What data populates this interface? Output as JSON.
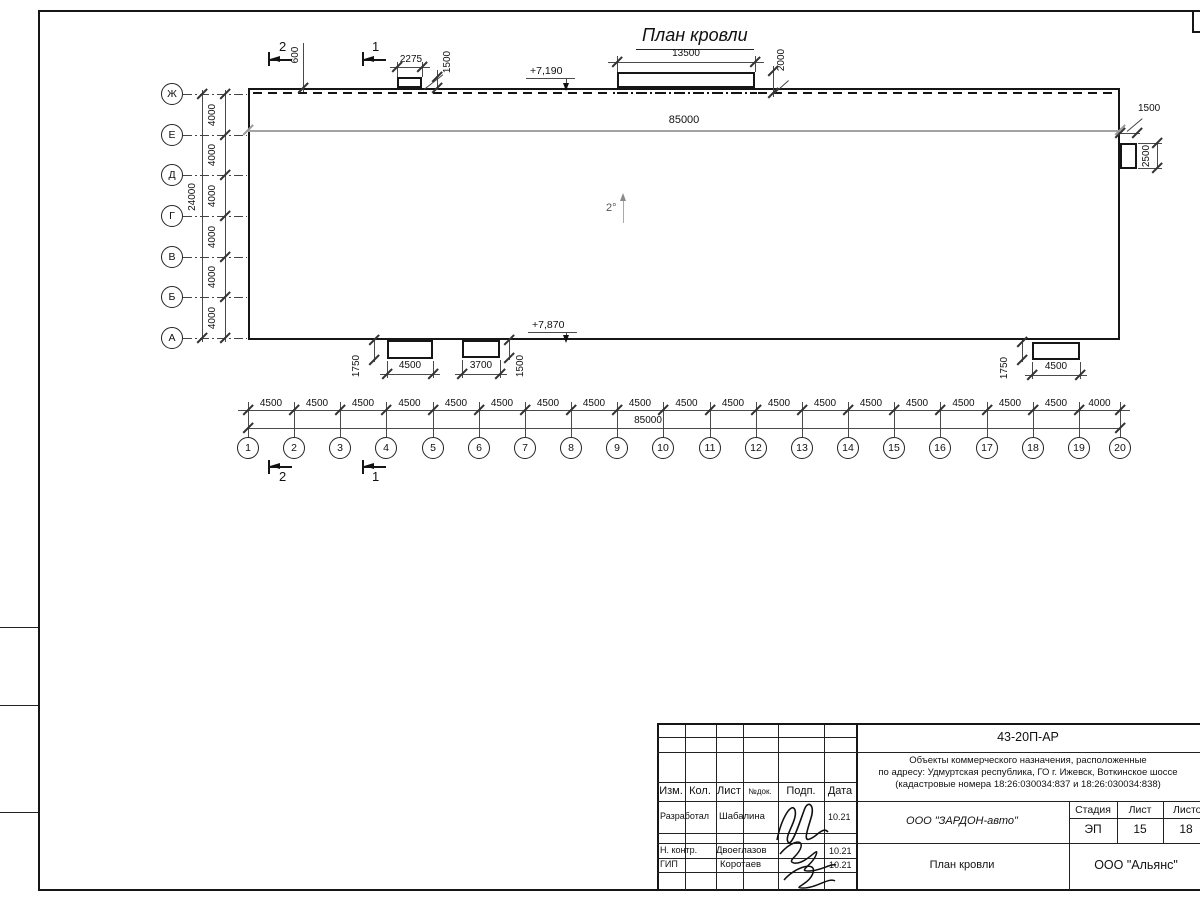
{
  "drawing": {
    "title": "План кровли",
    "slope_label": "2°",
    "elevation_top": "+7,190",
    "elevation_bottom": "+7,870",
    "total_width_top": "85000",
    "total_width_bottom": "85000"
  },
  "sections": {
    "s1": "1",
    "s2": "2"
  },
  "dims": {
    "top_parapet_offset": "600",
    "canopy_small_width": "2275",
    "canopy_small_depth": "1500",
    "canopy_big_width": "13500",
    "canopy_big_depth": "2000",
    "right_box_width": "1500",
    "right_box_depth": "2500",
    "bottom_a_width": "4500",
    "bottom_a_offset": "1750",
    "bottom_b_width": "3700",
    "bottom_b_offset": "1500",
    "bottom_c_width": "4500",
    "bottom_c_offset": "1750"
  },
  "grid": {
    "columns": [
      "1",
      "2",
      "3",
      "4",
      "5",
      "6",
      "7",
      "8",
      "9",
      "10",
      "11",
      "12",
      "13",
      "14",
      "15",
      "16",
      "17",
      "18",
      "19",
      "20"
    ],
    "column_bays": [
      "4500",
      "4500",
      "4500",
      "4500",
      "4500",
      "4500",
      "4500",
      "4500",
      "4500",
      "4500",
      "4500",
      "4500",
      "4500",
      "4500",
      "4500",
      "4500",
      "4500",
      "4500",
      "4000"
    ],
    "rows": [
      "Ж",
      "Е",
      "Д",
      "Г",
      "В",
      "Б",
      "А"
    ],
    "row_bays": [
      "4000",
      "4000",
      "4000",
      "4000",
      "4000",
      "4000"
    ],
    "rows_total": "24000"
  },
  "titleblock": {
    "doc_code": "43-20П-АР",
    "project_line1": "Объекты коммерческого назначения, расположенные",
    "project_line2": "по адресу: Удмуртская республика, ГО г. Ижевск, Воткинское шоссе",
    "project_line3": "(кадастровые номера 18:26:030034:837 и 18:26:030034:838)",
    "col_izm": "Изм.",
    "col_kol": "Кол.",
    "col_list": "Лист",
    "col_ndok": "№док.",
    "col_podp": "Подп.",
    "col_data": "Дата",
    "role1": "Разработал",
    "name1": "Шабалина",
    "date1": "10.21",
    "role2": "Н. контр.",
    "name2": "Двоеглазов",
    "date2": "10.21",
    "role3": "ГИП",
    "name3": "Коротаев",
    "date3": "10.21",
    "org": "ООО \"ЗАРДОН-авто\"",
    "stage_label": "Стадия",
    "stage": "ЭП",
    "sheet_label": "Лист",
    "sheet": "15",
    "sheets_label": "Листов",
    "sheets": "18",
    "drawing_name": "План кровли",
    "company": "ООО \"Альянс\""
  }
}
